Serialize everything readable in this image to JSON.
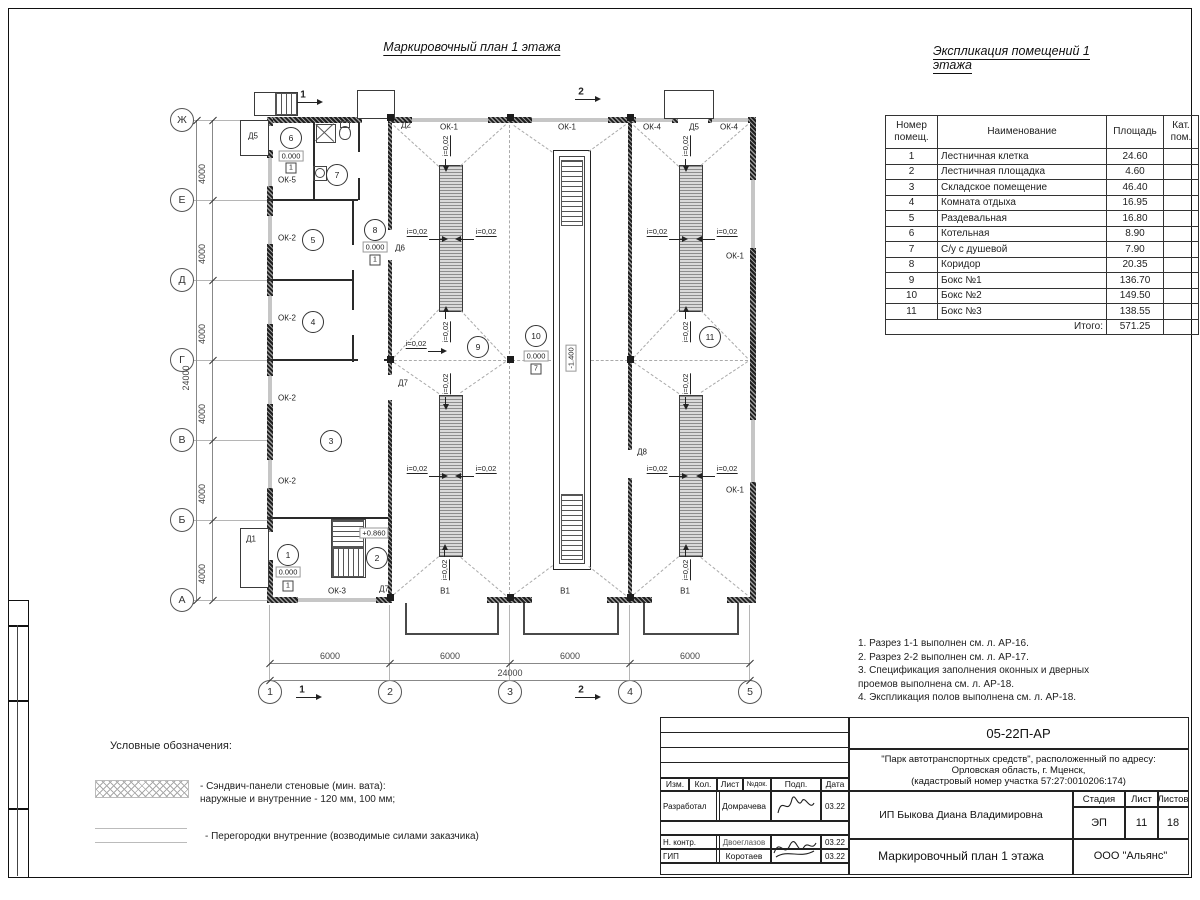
{
  "page": {
    "plan_title": "Маркировочный план 1 этажа",
    "explication_title": "Экспликация помещений 1 этажа"
  },
  "explication": {
    "headers": [
      "Номер\nпомещ.",
      "Наименование",
      "Площадь",
      "Кат.\nпом."
    ],
    "rows": [
      [
        "1",
        "Лестничная клетка",
        "24.60",
        ""
      ],
      [
        "2",
        "Лестничная площадка",
        "4.60",
        ""
      ],
      [
        "3",
        "Складское помещение",
        "46.40",
        ""
      ],
      [
        "4",
        "Комната отдыха",
        "16.95",
        ""
      ],
      [
        "5",
        "Раздевальная",
        "16.80",
        ""
      ],
      [
        "6",
        "Котельная",
        "8.90",
        ""
      ],
      [
        "7",
        "С/у с душевой",
        "7.90",
        ""
      ],
      [
        "8",
        "Коридор",
        "20.35",
        ""
      ],
      [
        "9",
        "Бокс №1",
        "136.70",
        ""
      ],
      [
        "10",
        "Бокс №2",
        "149.50",
        ""
      ],
      [
        "11",
        "Бокс №3",
        "138.55",
        ""
      ]
    ],
    "total_label": "Итого:",
    "total_value": "571.25"
  },
  "notes": [
    "1. Разрез 1-1 выполнен см. л. АР-16.",
    "2. Разрез 2-2 выполнен см. л. АР-17.",
    "3. Спецификация заполнения оконных и дверных\n    проемов выполнена см. л. АР-18.",
    "4. Экспликация полов выполнена см. л. АР-18."
  ],
  "legend": {
    "title": "Условные обозначения:",
    "item1": "- Сэндвич-панели стеновые (мин. вата):\nнаружные и внутренние - 120 мм, 100 мм;",
    "item2": "- Перегородки внутренние (возводимые силами заказчика)"
  },
  "title_block": {
    "code": "05-22П-АР",
    "project": "\"Парк автотранспортных средств\",  расположенный по адресу:\nОрловская область, г. Мценск,\n(кадастровый номер участка 57:27:0010206:174)",
    "client": "ИП Быкова Диана Владимировна",
    "sheet_title": "Маркировочный план 1 этажа",
    "company": "ООО \"Альянс\"",
    "col_izm": "Изм.",
    "col_kol": "Кол.",
    "col_list": "Лист",
    "col_ndok": "№док.",
    "col_podp": "Подп.",
    "col_data": "Дата",
    "stage_label": "Стадия",
    "sheet_label": "Лист",
    "sheets_label": "Листов",
    "stage": "ЭП",
    "sheet": "11",
    "sheets": "18",
    "r1_role": "Разработал",
    "r1_name": "Домрачева",
    "r1_date": "03.22",
    "r2_role": "Н. контр.",
    "r2_name": "Двоеглазов",
    "r2_date": "03.22",
    "r3_role": "ГИП",
    "r3_name": "Коротаев",
    "r3_date": "03.22"
  },
  "plan": {
    "slope_text": "i=0,02",
    "axes": {
      "rows": [
        {
          "label": "Ж",
          "y": 120
        },
        {
          "label": "Е",
          "y": 200
        },
        {
          "label": "Д",
          "y": 280
        },
        {
          "label": "Г",
          "y": 360
        },
        {
          "label": "В",
          "y": 440
        },
        {
          "label": "Б",
          "y": 520
        },
        {
          "label": "А",
          "y": 600
        }
      ],
      "cols": [
        {
          "label": "1",
          "x": 270
        },
        {
          "label": "2",
          "x": 390
        },
        {
          "label": "3",
          "x": 510
        },
        {
          "label": "4",
          "x": 630
        },
        {
          "label": "5",
          "x": 750
        }
      ]
    },
    "dims": {
      "v4000": "4000",
      "v24000": "24000",
      "h6000": "6000",
      "h24000": "24000"
    },
    "walls": [
      [
        267,
        117,
        95,
        6
      ],
      [
        388,
        117,
        24,
        6
      ],
      [
        488,
        117,
        44,
        6
      ],
      [
        608,
        117,
        28,
        6
      ],
      [
        672,
        117,
        6,
        6
      ],
      [
        708,
        117,
        4,
        6
      ],
      [
        748,
        117,
        8,
        6
      ],
      [
        267,
        597,
        31,
        6
      ],
      [
        376,
        597,
        16,
        6
      ],
      [
        487,
        597,
        45,
        6
      ],
      [
        607,
        597,
        45,
        6
      ],
      [
        727,
        597,
        29,
        6
      ],
      [
        267,
        117,
        6,
        9
      ],
      [
        267,
        150,
        6,
        8
      ],
      [
        267,
        186,
        6,
        30
      ],
      [
        267,
        244,
        6,
        52
      ],
      [
        267,
        324,
        6,
        52
      ],
      [
        267,
        404,
        6,
        56
      ],
      [
        267,
        488,
        6,
        44
      ],
      [
        267,
        560,
        6,
        43
      ],
      [
        750,
        117,
        6,
        63
      ],
      [
        750,
        248,
        6,
        172
      ],
      [
        750,
        482,
        6,
        121
      ],
      [
        388,
        123,
        4,
        107
      ],
      [
        388,
        260,
        4,
        115
      ],
      [
        388,
        400,
        4,
        197
      ],
      [
        628,
        123,
        4,
        327
      ],
      [
        628,
        478,
        4,
        119
      ]
    ],
    "windows": [
      [
        412,
        118,
        76,
        4
      ],
      [
        532,
        118,
        76,
        4
      ],
      [
        636,
        118,
        36,
        4
      ],
      [
        712,
        118,
        36,
        4
      ],
      [
        298,
        598,
        78,
        4
      ],
      [
        268,
        158,
        4,
        28
      ],
      [
        268,
        216,
        4,
        28
      ],
      [
        268,
        296,
        4,
        28
      ],
      [
        268,
        376,
        4,
        28
      ],
      [
        268,
        460,
        4,
        28
      ],
      [
        751,
        180,
        4,
        68
      ],
      [
        751,
        420,
        4,
        62
      ]
    ],
    "thin": [
      [
        313,
        123,
        2,
        77
      ],
      [
        358,
        123,
        2,
        29
      ],
      [
        358,
        178,
        2,
        22
      ],
      [
        267,
        199,
        91,
        2
      ],
      [
        352,
        201,
        2,
        44
      ],
      [
        352,
        270,
        2,
        40
      ],
      [
        352,
        335,
        2,
        27
      ],
      [
        267,
        279,
        85,
        2
      ],
      [
        267,
        359,
        91,
        2
      ],
      [
        384,
        359,
        4,
        2
      ],
      [
        267,
        517,
        121,
        2
      ]
    ],
    "pits": [
      [
        439,
        165,
        22,
        145
      ],
      [
        439,
        395,
        22,
        160
      ],
      [
        679,
        165,
        22,
        145
      ],
      [
        679,
        395,
        22,
        160
      ]
    ],
    "rects": [
      {
        "x": 553,
        "y": 150,
        "w": 36,
        "h": 418,
        "k": "outerpit"
      },
      {
        "x": 559,
        "y": 156,
        "w": 24,
        "h": 406,
        "k": "innerpit"
      },
      {
        "x": 254,
        "y": 92,
        "w": 42,
        "h": 22,
        "k": "porch"
      },
      {
        "x": 357,
        "y": 90,
        "w": 36,
        "h": 27,
        "k": "porch"
      },
      {
        "x": 664,
        "y": 90,
        "w": 48,
        "h": 27,
        "k": "porch"
      },
      {
        "x": 240,
        "y": 120,
        "w": 27,
        "h": 34,
        "k": "porch"
      },
      {
        "x": 240,
        "y": 528,
        "w": 27,
        "h": 58,
        "k": "porch"
      },
      {
        "x": 331,
        "y": 519,
        "w": 33,
        "h": 57,
        "k": "innerpit"
      },
      {
        "x": 405,
        "y": 603,
        "w": 90,
        "h": 30,
        "k": "apron"
      },
      {
        "x": 523,
        "y": 603,
        "w": 92,
        "h": 30,
        "k": "apron"
      },
      {
        "x": 643,
        "y": 603,
        "w": 92,
        "h": 30,
        "k": "apron"
      }
    ],
    "stairs": [
      {
        "x": 561,
        "y": 160,
        "w": 20,
        "h": 64,
        "dir": "h"
      },
      {
        "x": 561,
        "y": 494,
        "w": 20,
        "h": 64,
        "dir": "h"
      },
      {
        "x": 332,
        "y": 520,
        "w": 30,
        "h": 26,
        "dir": "h"
      },
      {
        "x": 332,
        "y": 548,
        "w": 30,
        "h": 27,
        "dir": "v"
      },
      {
        "x": 275,
        "y": 93,
        "w": 20,
        "h": 20,
        "dir": "v"
      }
    ],
    "dashes": [
      [
        394,
        125,
        439,
        166
      ],
      [
        506,
        125,
        461,
        166
      ],
      [
        439,
        310,
        394,
        358
      ],
      [
        461,
        310,
        506,
        358
      ],
      [
        394,
        362,
        439,
        393
      ],
      [
        506,
        362,
        461,
        393
      ],
      [
        439,
        557,
        394,
        595
      ],
      [
        461,
        557,
        506,
        595
      ],
      [
        634,
        125,
        679,
        166
      ],
      [
        748,
        125,
        701,
        166
      ],
      [
        679,
        310,
        634,
        358
      ],
      [
        701,
        310,
        748,
        358
      ],
      [
        634,
        362,
        679,
        393
      ],
      [
        748,
        362,
        701,
        393
      ],
      [
        679,
        557,
        634,
        595
      ],
      [
        701,
        557,
        748,
        595
      ],
      [
        514,
        125,
        553,
        152
      ],
      [
        626,
        125,
        589,
        152
      ],
      [
        553,
        566,
        514,
        595
      ],
      [
        589,
        566,
        626,
        595
      ],
      [
        394,
        360,
        506,
        360
      ],
      [
        634,
        360,
        748,
        360
      ],
      [
        512,
        360,
        551,
        360
      ],
      [
        591,
        360,
        628,
        360
      ],
      [
        510,
        125,
        510,
        595
      ]
    ],
    "squares": [
      [
        387,
        114
      ],
      [
        507,
        114
      ],
      [
        627,
        114
      ],
      [
        387,
        356
      ],
      [
        507,
        356
      ],
      [
        627,
        356
      ],
      [
        387,
        594
      ],
      [
        507,
        594
      ],
      [
        627,
        594
      ]
    ],
    "rooms": [
      {
        "n": "1",
        "x": 288,
        "y": 555
      },
      {
        "n": "2",
        "x": 377,
        "y": 558
      },
      {
        "n": "3",
        "x": 331,
        "y": 441
      },
      {
        "n": "4",
        "x": 313,
        "y": 322
      },
      {
        "n": "5",
        "x": 313,
        "y": 240
      },
      {
        "n": "6",
        "x": 291,
        "y": 138
      },
      {
        "n": "7",
        "x": 337,
        "y": 175
      },
      {
        "n": "8",
        "x": 375,
        "y": 230
      },
      {
        "n": "9",
        "x": 478,
        "y": 347
      },
      {
        "n": "10",
        "x": 536,
        "y": 336
      },
      {
        "n": "11",
        "x": 710,
        "y": 337
      }
    ],
    "levels": [
      {
        "s": "0.000",
        "x": 291,
        "y": 156
      },
      {
        "s": "0.000",
        "x": 375,
        "y": 247
      },
      {
        "s": "0.000",
        "x": 288,
        "y": 572
      },
      {
        "s": "0.000",
        "x": 536,
        "y": 356
      },
      {
        "s": "+0.860",
        "x": 374,
        "y": 533
      },
      {
        "s": "-1.400",
        "x": 571,
        "y": 358,
        "rot": 1
      }
    ],
    "fmarks": [
      {
        "s": "1",
        "x": 291,
        "y": 168
      },
      {
        "s": "1",
        "x": 375,
        "y": 260
      },
      {
        "s": "1",
        "x": 288,
        "y": 586
      },
      {
        "s": "7",
        "x": 536,
        "y": 369
      }
    ],
    "labels": [
      {
        "s": "ОК-1",
        "x": 449,
        "y": 127
      },
      {
        "s": "ОК-1",
        "x": 567,
        "y": 127
      },
      {
        "s": "ОК-4",
        "x": 652,
        "y": 127
      },
      {
        "s": "Д5",
        "x": 694,
        "y": 127
      },
      {
        "s": "ОК-4",
        "x": 729,
        "y": 127
      },
      {
        "s": "Д2",
        "x": 406,
        "y": 125
      },
      {
        "s": "Д5",
        "x": 253,
        "y": 136
      },
      {
        "s": "Д6",
        "x": 400,
        "y": 248
      },
      {
        "s": "Д7",
        "x": 403,
        "y": 383
      },
      {
        "s": "Д7",
        "x": 384,
        "y": 589
      },
      {
        "s": "ОК-3",
        "x": 337,
        "y": 591
      },
      {
        "s": "ОК-5",
        "x": 287,
        "y": 180
      },
      {
        "s": "ОК-2",
        "x": 287,
        "y": 238
      },
      {
        "s": "ОК-2",
        "x": 287,
        "y": 318
      },
      {
        "s": "ОК-2",
        "x": 287,
        "y": 398
      },
      {
        "s": "ОК-2",
        "x": 287,
        "y": 481
      },
      {
        "s": "Д1",
        "x": 251,
        "y": 539
      },
      {
        "s": "В1",
        "x": 445,
        "y": 591
      },
      {
        "s": "В1",
        "x": 565,
        "y": 591
      },
      {
        "s": "В1",
        "x": 685,
        "y": 591
      },
      {
        "s": "Д8",
        "x": 642,
        "y": 452
      },
      {
        "s": "ОК-1",
        "x": 735,
        "y": 256
      },
      {
        "s": "ОК-1",
        "x": 735,
        "y": 490
      }
    ],
    "slopes": [
      {
        "x": 417,
        "y": 232,
        "dir": "r"
      },
      {
        "x": 486,
        "y": 232,
        "dir": "l"
      },
      {
        "x": 417,
        "y": 469,
        "dir": "r"
      },
      {
        "x": 486,
        "y": 469,
        "dir": "l"
      },
      {
        "x": 657,
        "y": 232,
        "dir": "r"
      },
      {
        "x": 727,
        "y": 232,
        "dir": "l"
      },
      {
        "x": 657,
        "y": 469,
        "dir": "r"
      },
      {
        "x": 727,
        "y": 469,
        "dir": "l"
      },
      {
        "x": 416,
        "y": 344,
        "dir": "r"
      },
      {
        "x": 446,
        "y": 146,
        "dir": "d",
        "rot": 1
      },
      {
        "x": 446,
        "y": 332,
        "dir": "u",
        "rot": 1
      },
      {
        "x": 446,
        "y": 384,
        "dir": "d",
        "rot": 1
      },
      {
        "x": 445,
        "y": 570,
        "dir": "u",
        "rot": 1
      },
      {
        "x": 686,
        "y": 146,
        "dir": "d",
        "rot": 1
      },
      {
        "x": 686,
        "y": 332,
        "dir": "u",
        "rot": 1
      },
      {
        "x": 686,
        "y": 384,
        "dir": "d",
        "rot": 1
      },
      {
        "x": 686,
        "y": 570,
        "dir": "u",
        "rot": 1
      }
    ],
    "sections": [
      {
        "s": "1",
        "x": 303,
        "y": 95
      },
      {
        "s": "2",
        "x": 581,
        "y": 92
      },
      {
        "s": "1",
        "x": 302,
        "y": 690
      },
      {
        "s": "2",
        "x": 581,
        "y": 690
      }
    ]
  }
}
